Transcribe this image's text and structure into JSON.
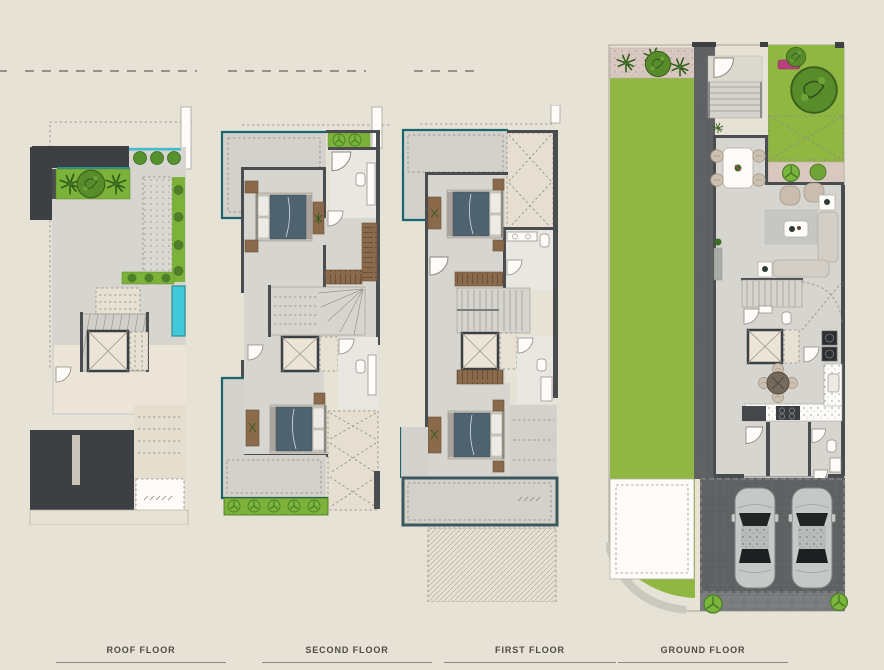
{
  "sheet": {
    "type": "architectural-floor-plan-presentation",
    "floors_shown": 4
  },
  "plans": [
    {
      "id": "roof",
      "label": "ROOF FLOOR"
    },
    {
      "id": "second",
      "label": "SECOND FLOOR"
    },
    {
      "id": "first",
      "label": "FIRST FLOOR"
    },
    {
      "id": "ground",
      "label": "GROUND FLOOR"
    }
  ],
  "palette": {
    "bg": "#e7e2d6",
    "floor": "#d6d5cf",
    "cream": "#ece4d7",
    "wall": "#4a4d4f",
    "charcoal": "#3d4043",
    "lawn": "#8fb741",
    "planter": "#7cb23a",
    "pool": "#41c9da",
    "teal": "#1b666d",
    "wood": "#8a6a4b",
    "bed": "#4e6270",
    "pink": "#d9c8c0",
    "rug": "#c6c7c3",
    "paver": "#606264",
    "rule": "#8f8b80",
    "rule2": "#96928a",
    "label": "#4f4b42"
  },
  "icons": {
    "tree": "tree-icon",
    "palm": "palm-icon",
    "bush": "bush-icon",
    "bed": "bed-icon",
    "elevator": "elevator-icon",
    "stairs": "stairs-icon",
    "car": "car-icon",
    "toilet": "toilet-icon",
    "door": "door-arc-icon",
    "dining_table": "dining-table-icon",
    "sofa": "sofa-icon",
    "armchair": "armchair-icon",
    "washer": "washer-icon",
    "pool": "pool-icon"
  }
}
